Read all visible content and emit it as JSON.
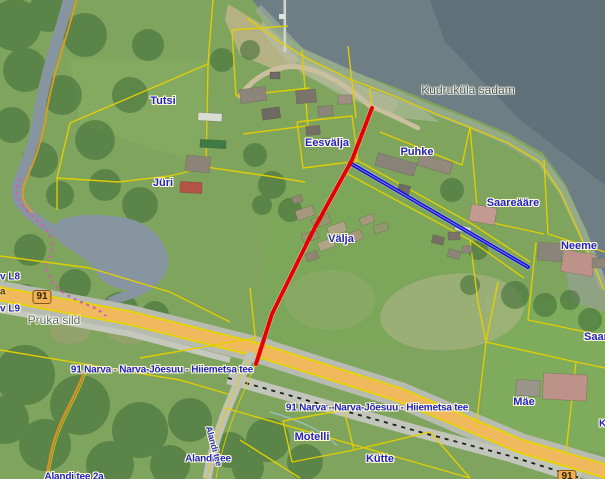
{
  "labels": {
    "places": [
      {
        "id": "tutsi",
        "text": "Tutsi"
      },
      {
        "id": "juri",
        "text": "Jüri"
      },
      {
        "id": "eesvalja",
        "text": "Eesvälja"
      },
      {
        "id": "puhke",
        "text": "Puhke"
      },
      {
        "id": "valja",
        "text": "Välja"
      },
      {
        "id": "saareaare",
        "text": "Saareääre"
      },
      {
        "id": "neeme",
        "text": "Neeme"
      },
      {
        "id": "motelli",
        "text": "Motelli"
      },
      {
        "id": "kutte",
        "text": "Kütte"
      },
      {
        "id": "mae",
        "text": "Mäe"
      },
      {
        "id": "saare_clipped",
        "text": "Saare"
      }
    ],
    "landmarks": [
      {
        "id": "harbor",
        "text": "Kudruküla sadam"
      },
      {
        "id": "bridge",
        "text": "Pruka sild"
      }
    ],
    "roads": [
      {
        "id": "hwy_label_west",
        "text": "91 Narva - Narva-Jõesuu - Hiiemetsa tee"
      },
      {
        "id": "hwy_label_east",
        "text": "91 Narva - Narva-Jõesuu - Hiiemetsa tee"
      },
      {
        "id": "alandi_tee",
        "text": "Alandi tee"
      },
      {
        "id": "alandi_tee_along_road",
        "text": "Alandi tee"
      },
      {
        "id": "alandi_tee_2a",
        "text": "Alandi tee 2a"
      }
    ],
    "road_number_badges": [
      {
        "id": "badge_91_west",
        "text": "91"
      },
      {
        "id": "badge_91_east",
        "text": "91"
      }
    ],
    "edge_fragments": [
      {
        "id": "ditch_l8",
        "text": "v L8"
      },
      {
        "id": "ditch_l9",
        "text": "v L9"
      },
      {
        "id": "onroad_a",
        "text": "a"
      },
      {
        "id": "right_edge_k",
        "text": "K"
      }
    ]
  },
  "annotations": {
    "red_route_line": {
      "color": "#e60000"
    },
    "blue_route_line": {
      "color": "#1414cc"
    }
  },
  "palette": {
    "water": "#6e7e85",
    "water_deep": "#5d6d75",
    "water_shallow": "#a0ae9f",
    "land": "#7ea45e",
    "forest": "#44703a",
    "parcel_line": "#e5d000",
    "river_boundary": "#e09a28",
    "trail_pink": "#cf5fb0",
    "highway_fill": "#f0b95d",
    "highway_casing": "#e8d400",
    "asphalt": "#b7bbb0",
    "label_blue": "#2222cc",
    "label_gray": "#4c5a60"
  }
}
